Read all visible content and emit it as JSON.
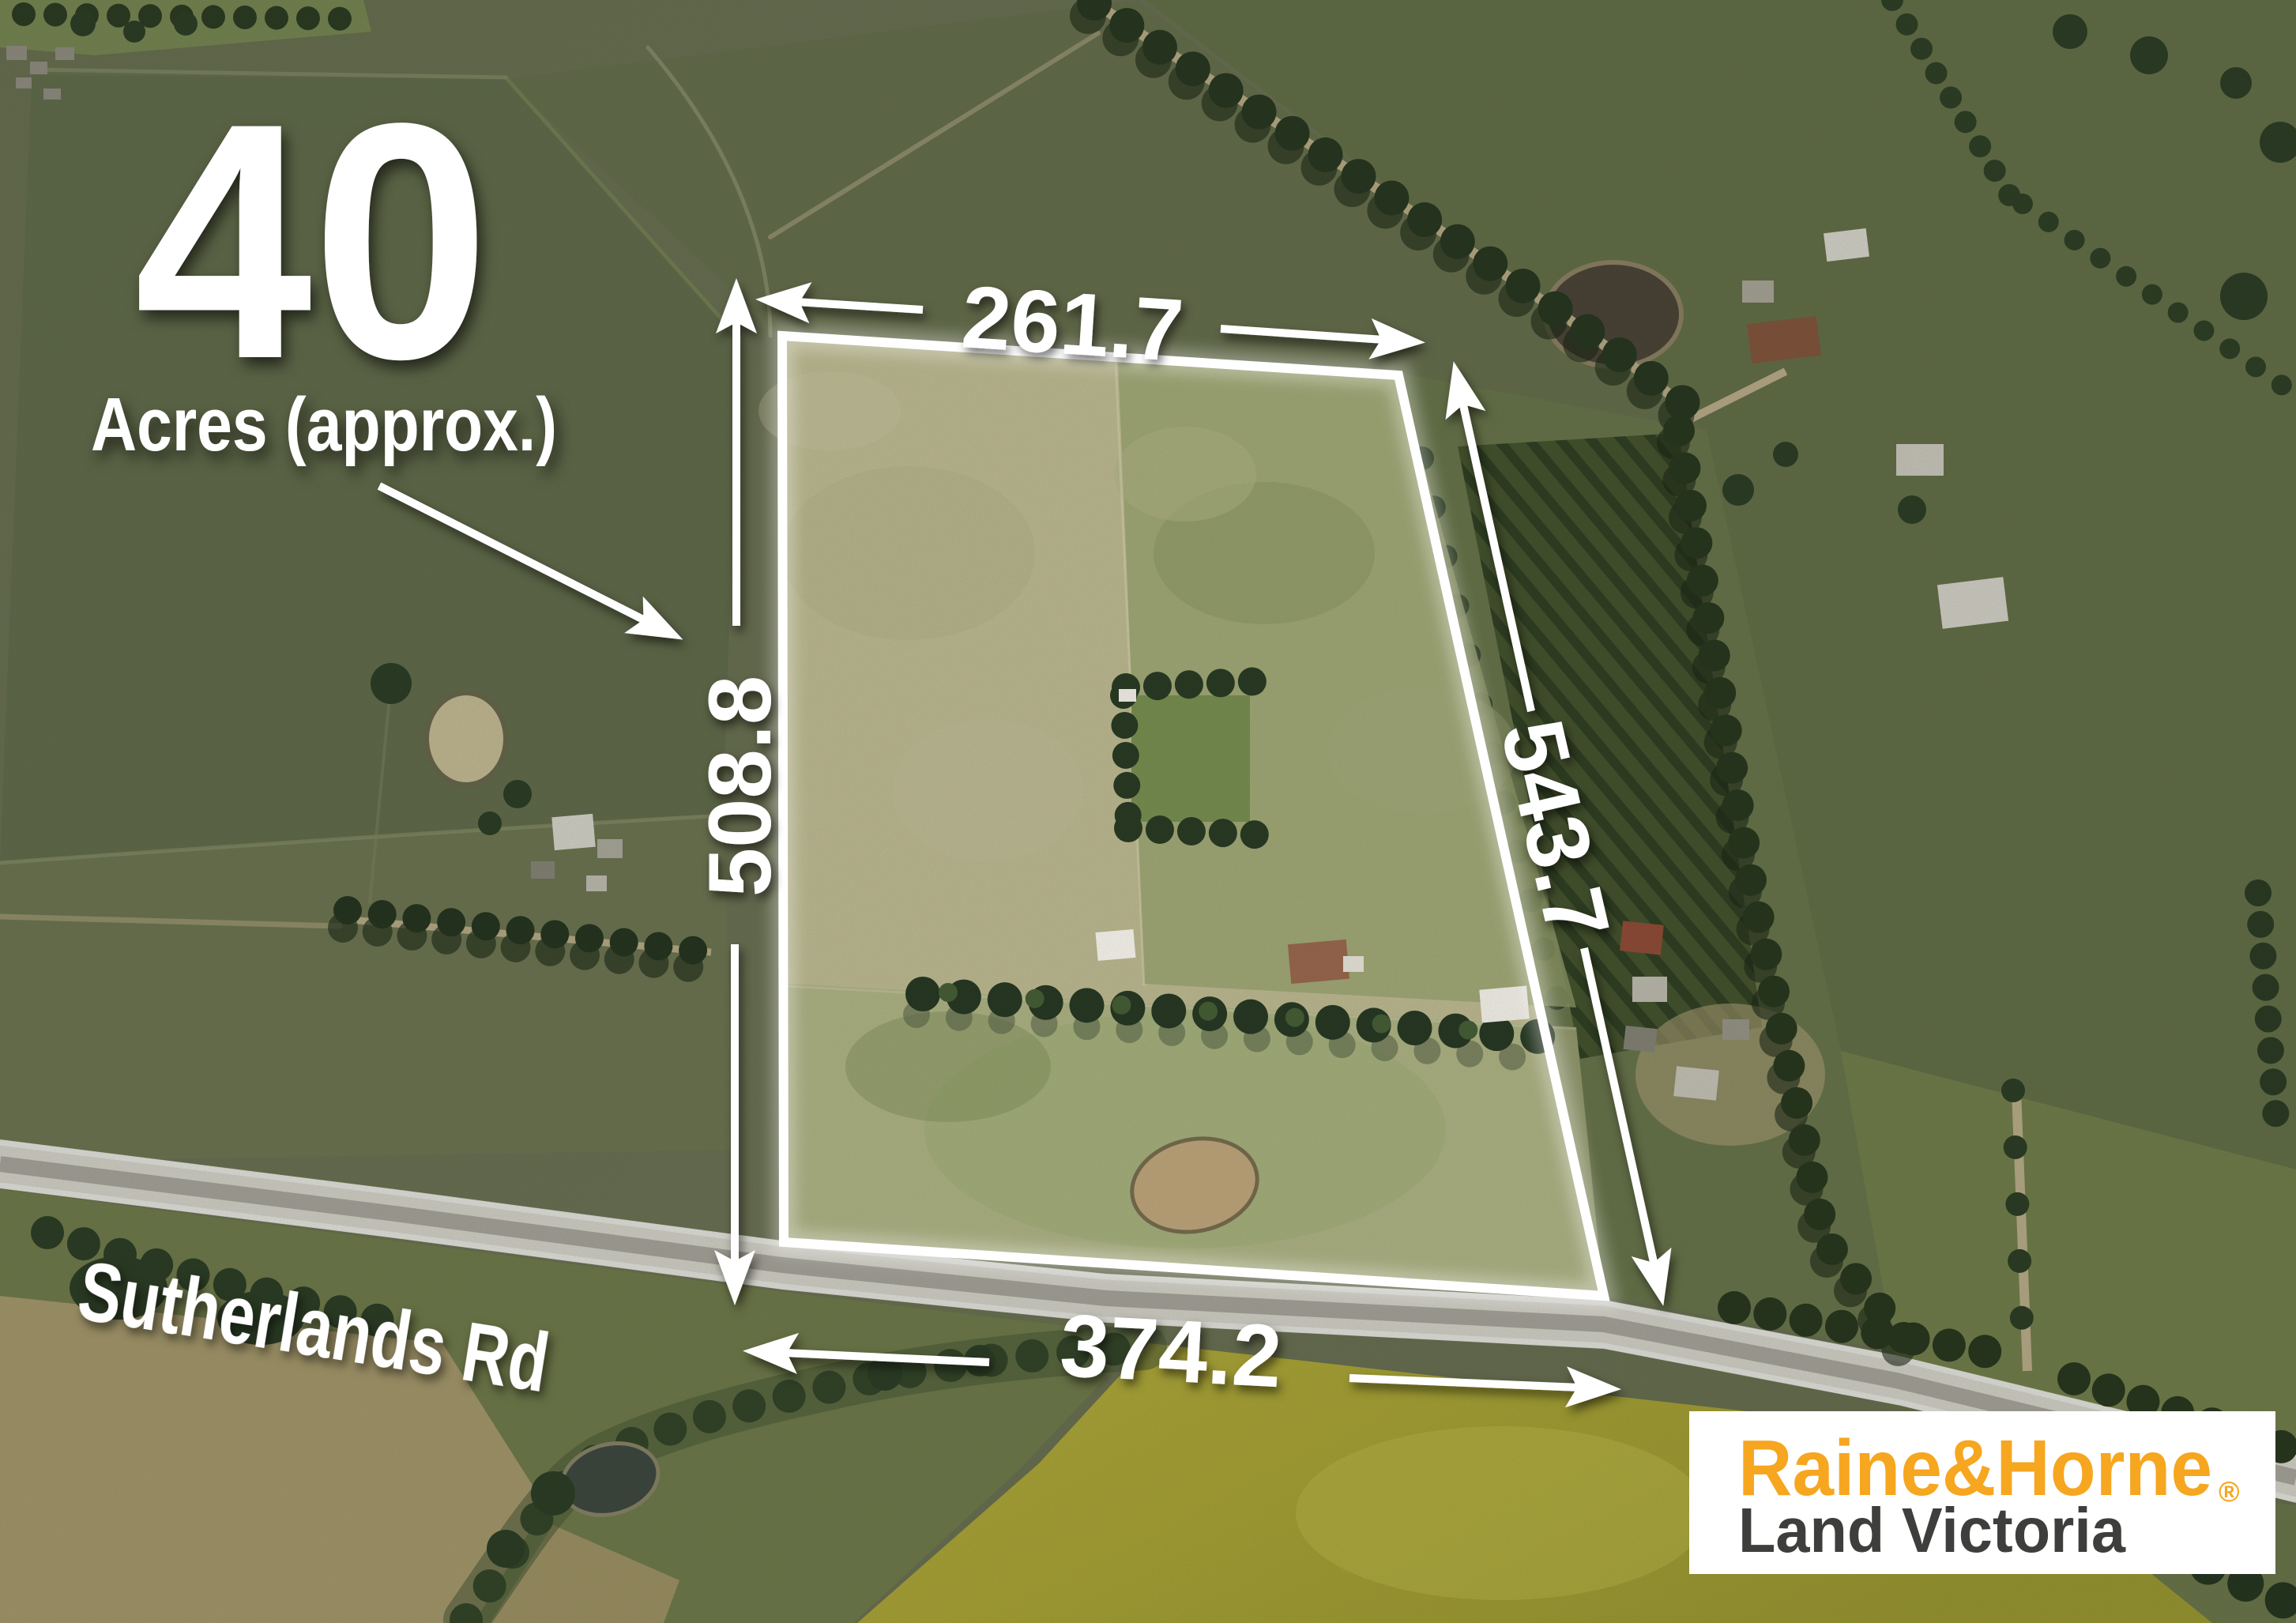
{
  "headline": {
    "number": "40",
    "label": "Acres (approx.)"
  },
  "dimensions": {
    "top": "261.7",
    "left": "508.8",
    "right": "543.7",
    "bottom": "374.2"
  },
  "road": {
    "name": "Sutherlands Rd"
  },
  "parcel": {
    "border_color": "#FFFFFF",
    "annotation_color": "#FFFFFF"
  },
  "logo": {
    "brand": "Raine&Horne",
    "registered_mark": "®",
    "division": "Land Victoria",
    "brand_color": "#F6A61F",
    "division_color": "#3E3E3C",
    "background_color": "#FFFFFF"
  }
}
